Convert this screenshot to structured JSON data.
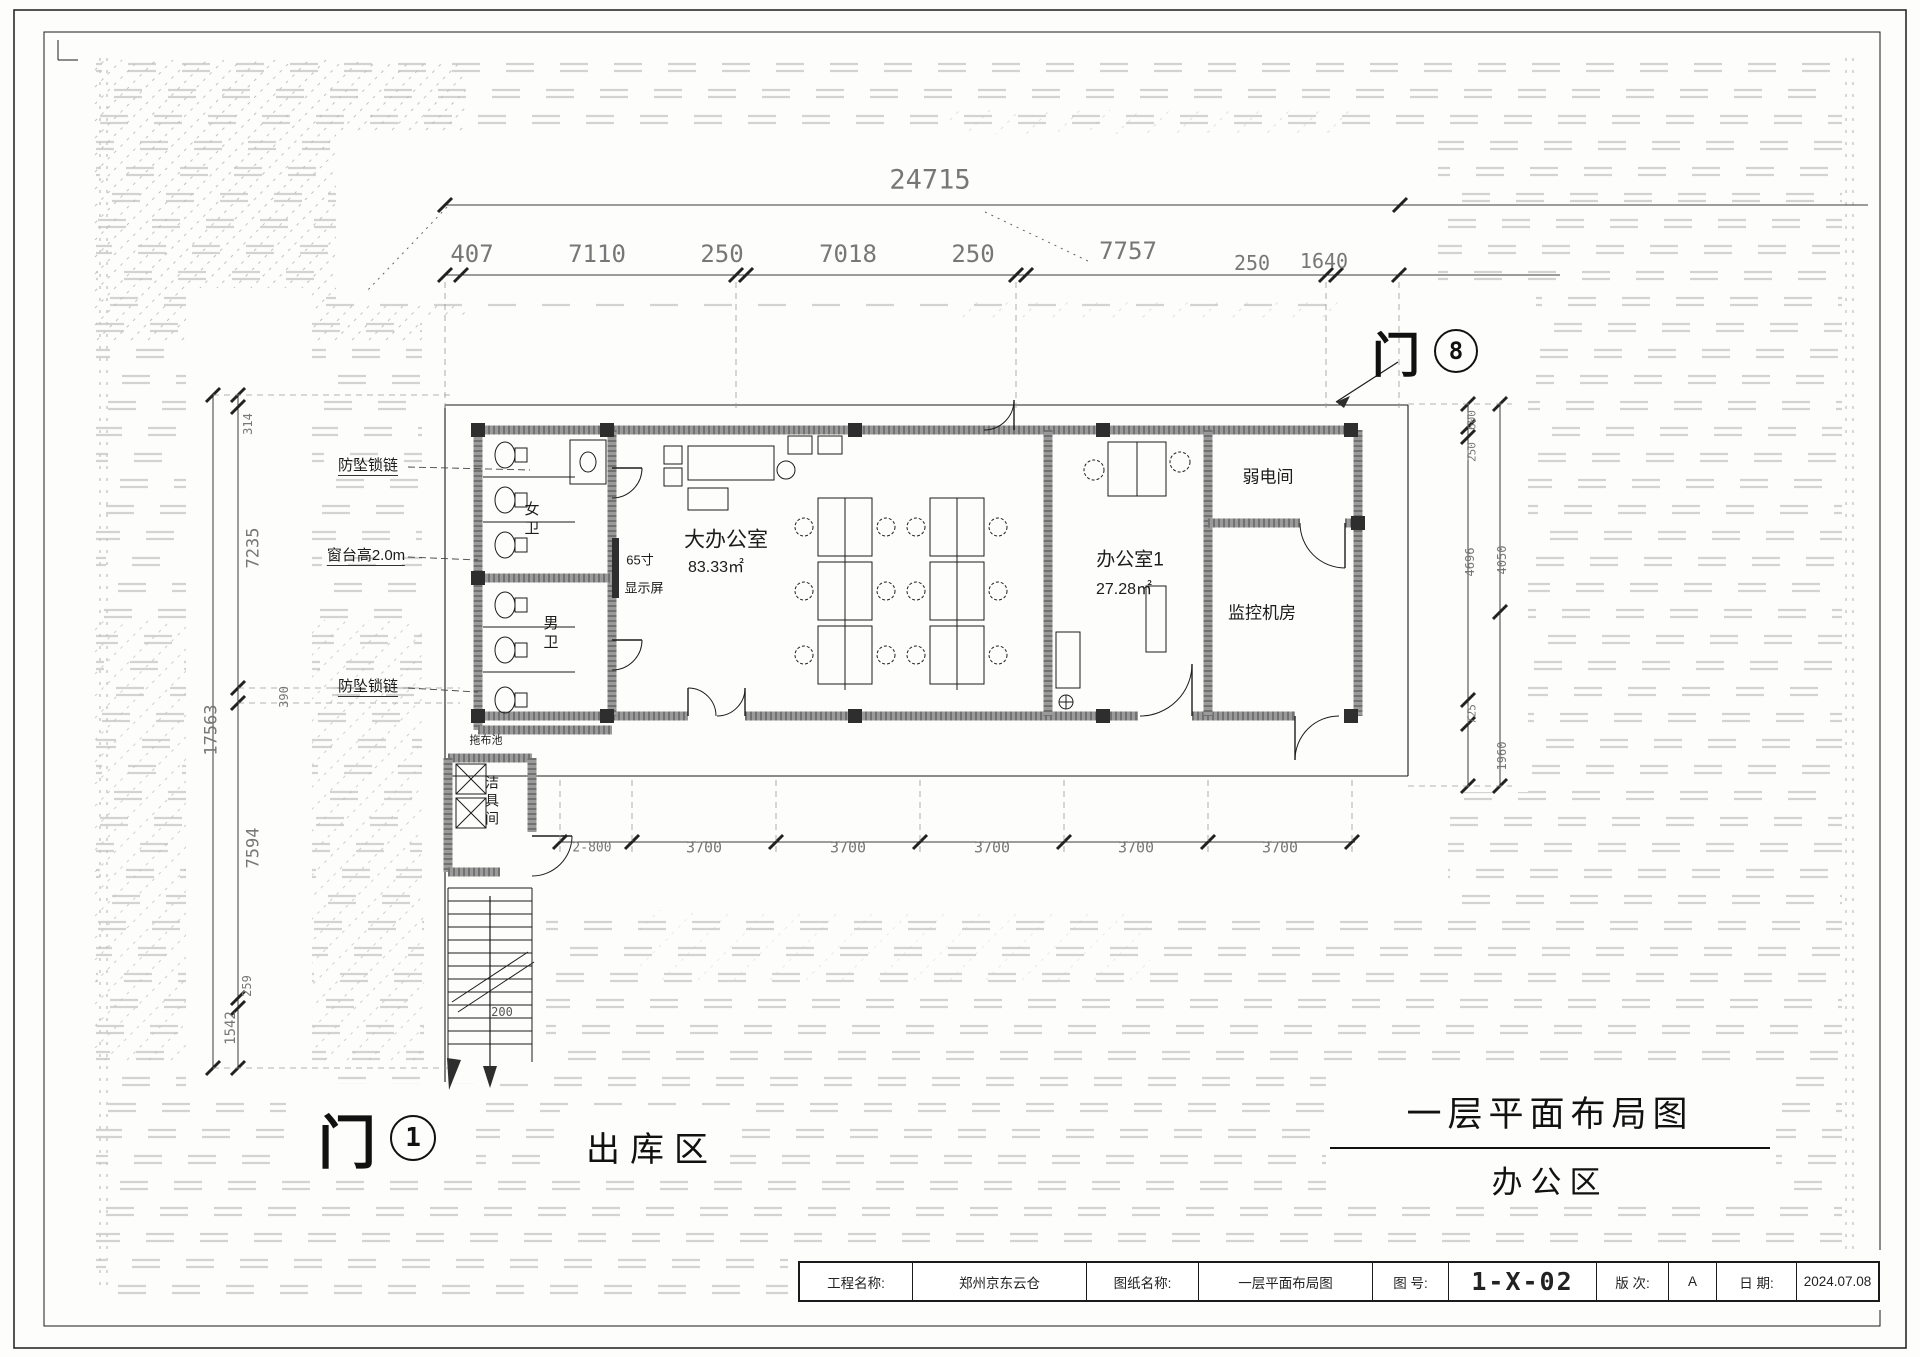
{
  "sheet": {
    "main_title": "一层平面布局图",
    "sub_title": "办公区",
    "door_1": {
      "char": "门",
      "num": "1"
    },
    "door_8": {
      "char": "门",
      "num": "8"
    },
    "outbound_area": "出库区"
  },
  "title_block": {
    "cells": [
      "工程名称:",
      "郑州京东云仓",
      "图纸名称:",
      "一层平面布局图",
      "图 号:",
      "1-X-02",
      "版 次:",
      "A",
      "日 期:",
      "2024.07.08"
    ]
  },
  "colors": {
    "line": "#1c1c1c",
    "dim": "#7d7d7d",
    "pattern": "#c9c9c9",
    "wall": "#9a9a9a"
  },
  "labels": [
    {
      "n": "dim-top-total",
      "t": "24715",
      "x": 930,
      "y": 180,
      "s": 27,
      "c": "#777"
    },
    {
      "n": "dim-top-seg-1",
      "t": "407",
      "x": 472,
      "y": 254,
      "s": 24,
      "c": "#777"
    },
    {
      "n": "dim-top-seg-2",
      "t": "7110",
      "x": 597,
      "y": 254,
      "s": 24,
      "c": "#777"
    },
    {
      "n": "dim-top-seg-3",
      "t": "250",
      "x": 722,
      "y": 254,
      "s": 24,
      "c": "#777"
    },
    {
      "n": "dim-top-seg-4",
      "t": "7018",
      "x": 848,
      "y": 254,
      "s": 24,
      "c": "#777"
    },
    {
      "n": "dim-top-seg-5",
      "t": "250",
      "x": 973,
      "y": 254,
      "s": 24,
      "c": "#777"
    },
    {
      "n": "dim-top-seg-6",
      "t": "7757",
      "x": 1128,
      "y": 251,
      "s": 24,
      "c": "#777"
    },
    {
      "n": "dim-top-seg-7",
      "t": "250",
      "x": 1252,
      "y": 263,
      "s": 20,
      "c": "#777"
    },
    {
      "n": "dim-top-seg-8",
      "t": "1640",
      "x": 1324,
      "y": 261,
      "s": 20,
      "c": "#777"
    },
    {
      "n": "note-anti-fall-chain-1",
      "t": "防坠锁链",
      "x": 368,
      "y": 467,
      "s": 15,
      "u": 1
    },
    {
      "n": "note-sill-height",
      "t": "窗台高2.0m",
      "x": 366,
      "y": 557,
      "s": 15,
      "u": 1
    },
    {
      "n": "note-anti-fall-chain-2",
      "t": "防坠锁链",
      "x": 368,
      "y": 688,
      "s": 15,
      "u": 1
    },
    {
      "n": "room-big-office",
      "t": "大办公室",
      "x": 726,
      "y": 540,
      "s": 21
    },
    {
      "n": "room-big-office-area",
      "t": "83.33㎡",
      "x": 716,
      "y": 568,
      "s": 16
    },
    {
      "n": "note-tv-size",
      "t": "65寸",
      "x": 640,
      "y": 560,
      "s": 13
    },
    {
      "n": "note-tv-screen",
      "t": "显示屏",
      "x": 644,
      "y": 588,
      "s": 13
    },
    {
      "n": "room-office-1",
      "t": "办公室1",
      "x": 1130,
      "y": 560,
      "s": 19
    },
    {
      "n": "room-office-1-area",
      "t": "27.28㎡",
      "x": 1124,
      "y": 590,
      "s": 16
    },
    {
      "n": "room-weak-current",
      "t": "弱电间",
      "x": 1268,
      "y": 477,
      "s": 17
    },
    {
      "n": "room-monitor",
      "t": "监控机房",
      "x": 1262,
      "y": 613,
      "s": 17
    },
    {
      "n": "room-women-wc",
      "t": "女卫",
      "x": 531,
      "y": 520,
      "s": 15,
      "v": 1
    },
    {
      "n": "room-men-wc",
      "t": "男卫",
      "x": 550,
      "y": 634,
      "s": 15,
      "v": 1
    },
    {
      "n": "room-cleaning",
      "t": "洁具间",
      "x": 492,
      "y": 802,
      "s": 14,
      "v": 1
    },
    {
      "n": "note-mop-sink",
      "t": "拖布池",
      "x": 486,
      "y": 741,
      "s": 11
    },
    {
      "n": "dim-corridor-step",
      "t": "2-800",
      "x": 592,
      "y": 848,
      "s": 13,
      "c": "#777"
    },
    {
      "n": "dim-corridor-1",
      "t": "3700",
      "x": 704,
      "y": 848,
      "s": 15,
      "c": "#777"
    },
    {
      "n": "dim-corridor-2",
      "t": "3700",
      "x": 848,
      "y": 848,
      "s": 15,
      "c": "#777"
    },
    {
      "n": "dim-corridor-3",
      "t": "3700",
      "x": 992,
      "y": 848,
      "s": 15,
      "c": "#777"
    },
    {
      "n": "dim-corridor-4",
      "t": "3700",
      "x": 1136,
      "y": 848,
      "s": 15,
      "c": "#777"
    },
    {
      "n": "dim-corridor-5",
      "t": "3700",
      "x": 1280,
      "y": 848,
      "s": 15,
      "c": "#777"
    },
    {
      "n": "dim-stair-width",
      "t": "200",
      "x": 502,
      "y": 1012,
      "s": 12,
      "c": "#555"
    },
    {
      "n": "dim-left-1",
      "t": "314",
      "x": 248,
      "y": 424,
      "s": 12,
      "r": -90,
      "c": "#777"
    },
    {
      "n": "dim-left-2",
      "t": "7235",
      "x": 254,
      "y": 548,
      "s": 17,
      "r": -90,
      "c": "#777"
    },
    {
      "n": "dim-left-3",
      "t": "390",
      "x": 284,
      "y": 697,
      "s": 12,
      "r": -90,
      "c": "#777"
    },
    {
      "n": "dim-left-total",
      "t": "17563",
      "x": 212,
      "y": 730,
      "s": 17,
      "r": -90,
      "c": "#777"
    },
    {
      "n": "dim-left-4",
      "t": "7594",
      "x": 254,
      "y": 848,
      "s": 17,
      "r": -90,
      "c": "#777"
    },
    {
      "n": "dim-left-5",
      "t": "259",
      "x": 247,
      "y": 986,
      "s": 12,
      "r": -90,
      "c": "#777"
    },
    {
      "n": "dim-left-6",
      "t": "1542",
      "x": 231,
      "y": 1028,
      "s": 14,
      "r": -90,
      "c": "#777"
    },
    {
      "n": "dim-right-1",
      "t": "600",
      "x": 1472,
      "y": 420,
      "s": 11,
      "r": -90,
      "c": "#777"
    },
    {
      "n": "dim-right-2",
      "t": "250",
      "x": 1472,
      "y": 452,
      "s": 11,
      "r": -90,
      "c": "#777"
    },
    {
      "n": "dim-right-3",
      "t": "4696",
      "x": 1470,
      "y": 562,
      "s": 12,
      "r": -90,
      "c": "#777"
    },
    {
      "n": "dim-right-4",
      "t": "725",
      "x": 1472,
      "y": 714,
      "s": 11,
      "r": -90,
      "c": "#777"
    },
    {
      "n": "dim-right-5",
      "t": "4050",
      "x": 1502,
      "y": 560,
      "s": 12,
      "r": -90,
      "c": "#777"
    },
    {
      "n": "dim-right-6",
      "t": "1960",
      "x": 1502,
      "y": 756,
      "s": 12,
      "r": -90,
      "c": "#777"
    }
  ]
}
